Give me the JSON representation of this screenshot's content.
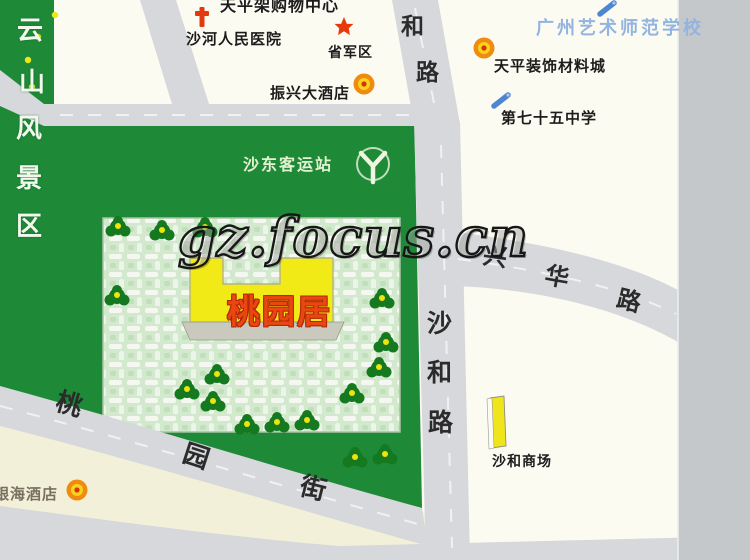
{
  "watermark": {
    "text": "gz.focus.cn"
  },
  "scenic_area": {
    "name": "云山风景区",
    "chars": [
      "云",
      "山",
      "风",
      "景",
      "区"
    ]
  },
  "park": {
    "station": {
      "label": "沙东客运站",
      "icon": "y-logo"
    },
    "residence": {
      "label": "桃园居"
    }
  },
  "roads": {
    "he_lu": {
      "name": "和路",
      "chars": [
        "和",
        "路"
      ]
    },
    "sha_he_lu": {
      "name": "沙和路",
      "chars": [
        "沙",
        "和",
        "路"
      ]
    },
    "xing_hua_lu": {
      "name": "兴华路",
      "chars": [
        "兴",
        "华",
        "路"
      ]
    },
    "tao_yuan_jie": {
      "name": "桃园街",
      "chars": [
        "桃",
        "园",
        "街"
      ]
    }
  },
  "pois": {
    "shopping_center": {
      "label": "天平架购物中心"
    },
    "hospital": {
      "label": "沙河人民医院",
      "icon": "red-cross"
    },
    "military_region": {
      "label": "省军区",
      "icon": "red-star"
    },
    "zhenxing_hotel": {
      "label": "振兴大酒店",
      "icon": "orange-badge"
    },
    "art_school": {
      "label": "广州艺术师范学校",
      "icon": "blue-pen"
    },
    "material_city": {
      "label": "天平装饰材料城",
      "icon": "orange-badge"
    },
    "no75_middle_school": {
      "label": "第七十五中学",
      "icon": "blue-pen"
    },
    "shahe_market": {
      "label": "沙和商场",
      "icon": "yellow-building"
    },
    "yinhai_hotel": {
      "label": "银海酒店",
      "icon": "orange-badge"
    }
  },
  "colors": {
    "park_green": "#1e8a38",
    "hatch_bg": "#d3e9cd",
    "road_gray": "#d6d8db",
    "building_yellow": "#f2ea16",
    "residence_red": "#ea4612",
    "school_blue": "#92b4df",
    "cream": "#f3f0da",
    "map_edge_gray": "#c4c8ca"
  }
}
